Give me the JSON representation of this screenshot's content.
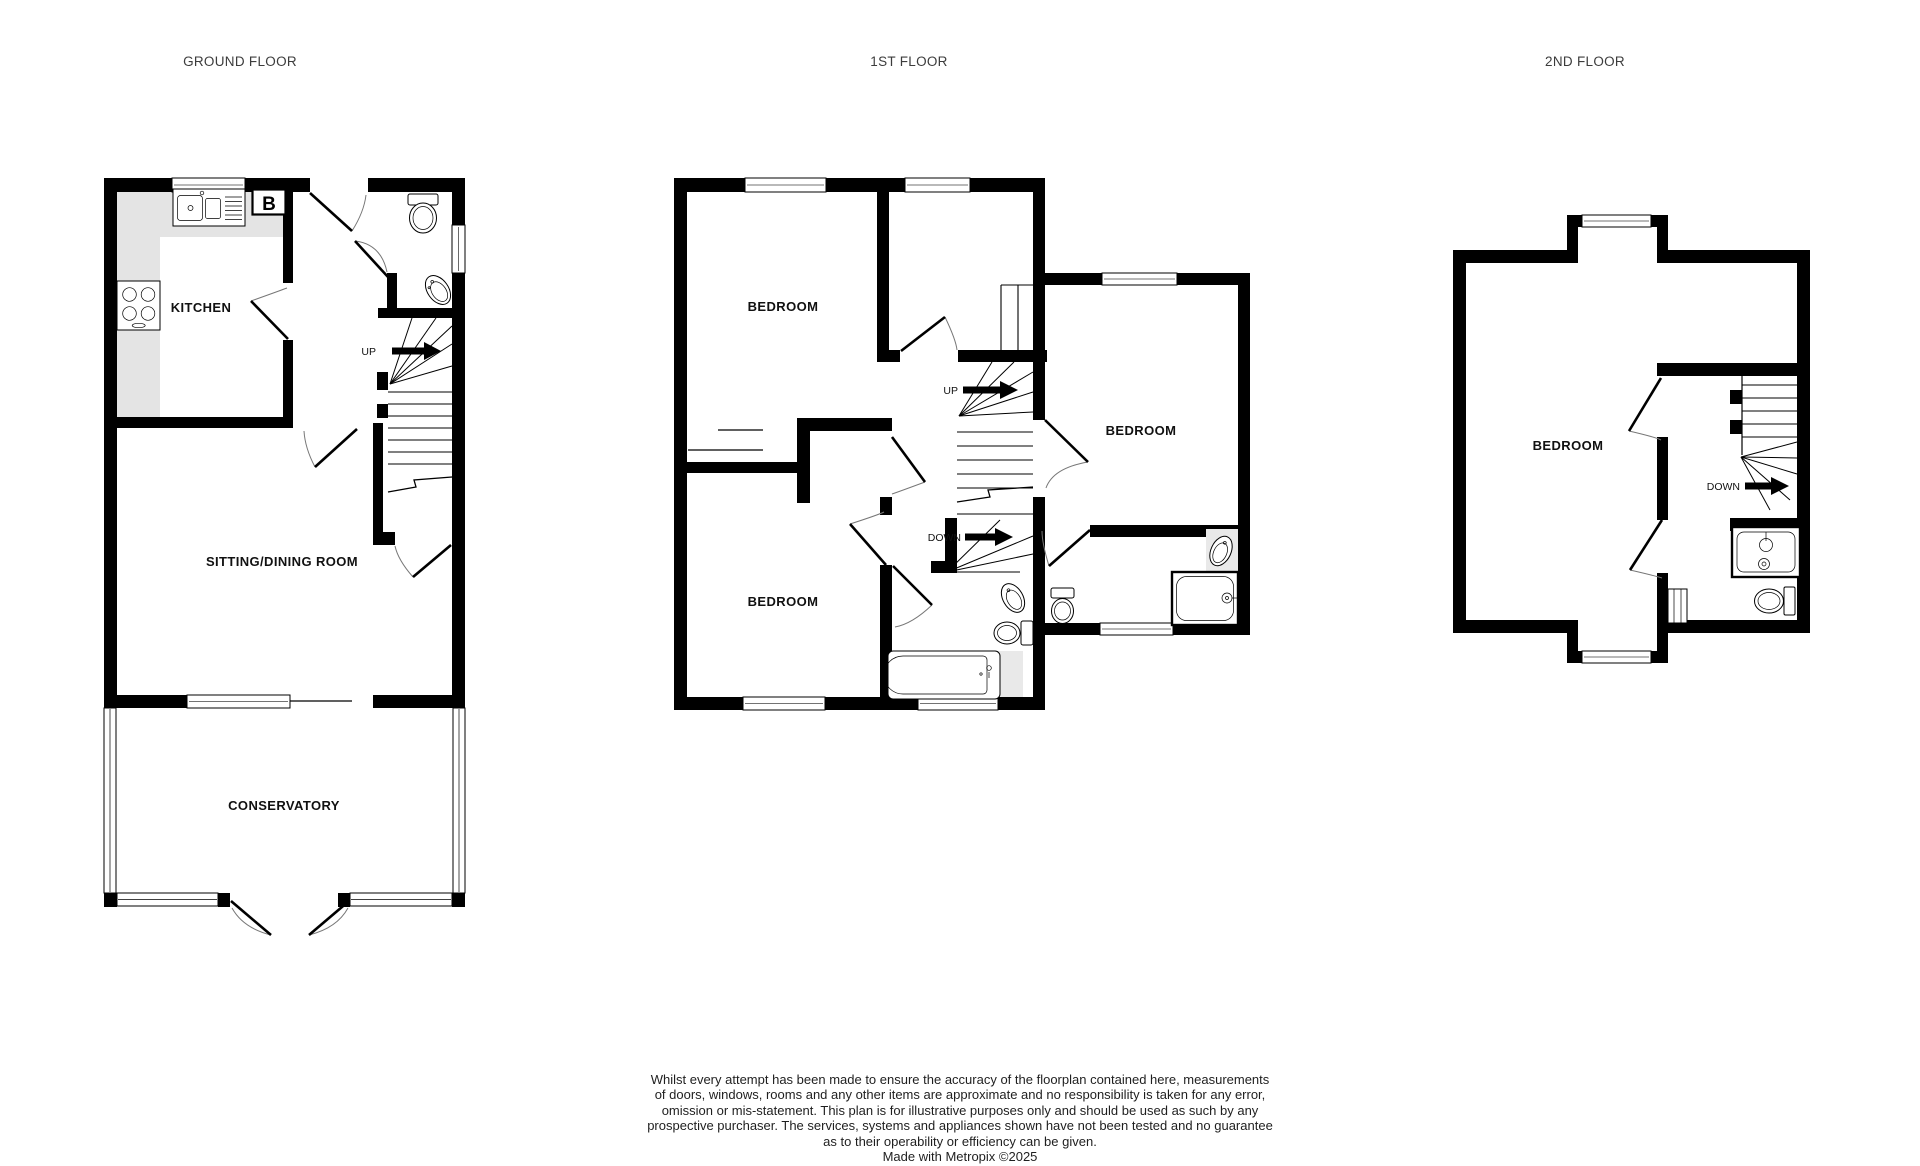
{
  "page": {
    "background": "#ffffff"
  },
  "floors": {
    "ground": {
      "title": "GROUND FLOOR",
      "rooms": {
        "kitchen": "KITCHEN",
        "sitting_dining": "SITTING/DINING ROOM",
        "conservatory": "CONSERVATORY"
      },
      "stairs": {
        "up": "UP"
      },
      "boiler_label": "B",
      "icons": [
        "kitchen-sink-icon",
        "boiler-icon",
        "hob-icon",
        "toilet-icon",
        "basin-icon",
        "staircase-up-icon",
        "front-door-icon",
        "french-doors-icon",
        "window-icon"
      ]
    },
    "first": {
      "title": "1ST FLOOR",
      "rooms": {
        "bedroom_front": "BEDROOM",
        "bedroom_back": "BEDROOM",
        "bedroom_side": "BEDROOM"
      },
      "stairs": {
        "up": "UP",
        "down": "DOWN"
      },
      "icons": [
        "bath-icon",
        "toilet-icon",
        "basin-icon",
        "shower-icon",
        "staircase-icon",
        "window-icon",
        "door-icon"
      ]
    },
    "second": {
      "title": "2ND FLOOR",
      "rooms": {
        "bedroom": "BEDROOM"
      },
      "stairs": {
        "down": "DOWN"
      },
      "icons": [
        "sink-icon",
        "toilet-icon",
        "radiator-icon",
        "staircase-down-icon",
        "window-icon",
        "door-icon"
      ]
    }
  },
  "footer": {
    "lines": [
      "Whilst every attempt has been made to ensure the accuracy of the floorplan contained here, measurements",
      "of doors, windows, rooms and any other items are approximate and no responsibility is taken for any error,",
      "omission or mis-statement. This plan is for illustrative purposes only and should be used as such by any",
      "prospective purchaser. The services, systems and appliances shown have not been tested and no guarantee",
      "as to their operability or efficiency can be given."
    ],
    "credit": "Made with Metropix ©2025"
  },
  "colors": {
    "wall": "#000000",
    "background": "#ffffff",
    "counter": "#e4e4e4",
    "tile": "#e9e9e9",
    "label_text": "#111111",
    "title_text": "#3c3c3c",
    "footer_text": "#1f1f1f"
  }
}
